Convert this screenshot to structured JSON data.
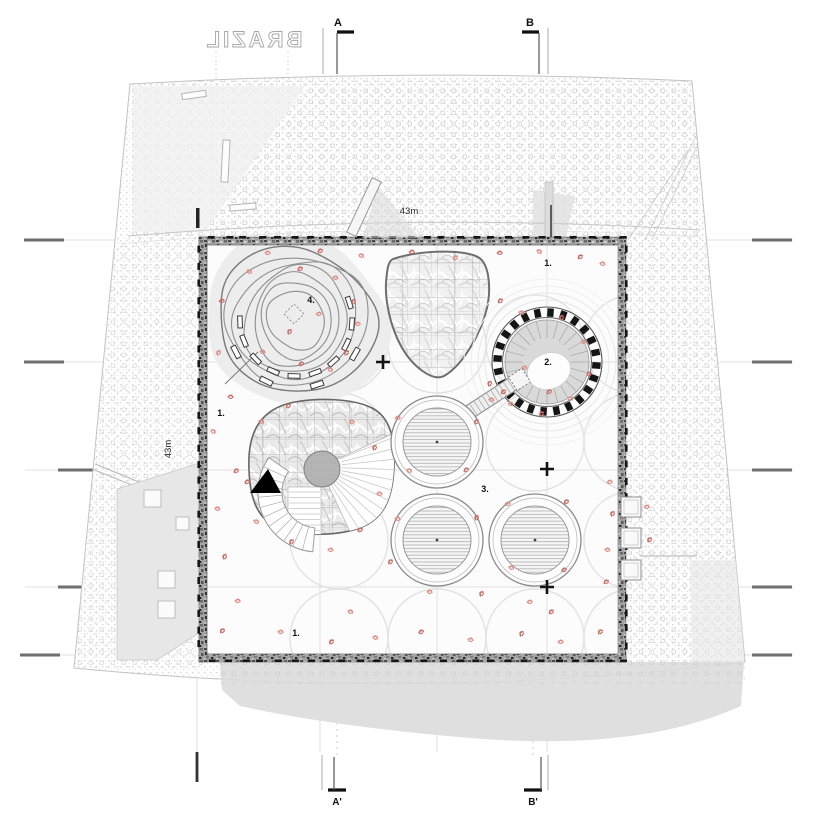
{
  "drawing": {
    "project_name_mirrored": "BRAZIL",
    "dim_top": "43m",
    "dim_left": "43m",
    "section_top_a": "A",
    "section_top_b": "B",
    "section_bottom_a": "A'",
    "section_bottom_b": "B'"
  },
  "area_labels": [
    {
      "text": "1.",
      "x": 548,
      "y": 266
    },
    {
      "text": "1.",
      "x": 221,
      "y": 416
    },
    {
      "text": "1.",
      "x": 296,
      "y": 636
    },
    {
      "text": "2.",
      "x": 548,
      "y": 365
    },
    {
      "text": "3.",
      "x": 485,
      "y": 492
    },
    {
      "text": "4.",
      "x": 311,
      "y": 303
    }
  ],
  "crosses": [
    [
      383,
      362
    ],
    [
      547,
      469
    ],
    [
      547,
      587
    ]
  ],
  "colors": {
    "figure_a": "#dd8e86",
    "figure_b": "#c96e66",
    "wall_base": "#a3a3a3",
    "shadow": "#dcdcdc",
    "faint_line": "#e2e2e2",
    "ink": "#141414"
  },
  "figures": [
    [
      268,
      252,
      20
    ],
    [
      320,
      250,
      -15
    ],
    [
      362,
      255,
      40
    ],
    [
      412,
      251,
      10
    ],
    [
      455,
      257,
      -30
    ],
    [
      500,
      252,
      15
    ],
    [
      540,
      251,
      50
    ],
    [
      580,
      256,
      -20
    ],
    [
      603,
      263,
      30
    ],
    [
      222,
      300,
      10
    ],
    [
      218,
      352,
      -40
    ],
    [
      231,
      396,
      25
    ],
    [
      214,
      431,
      60
    ],
    [
      236,
      470,
      -15
    ],
    [
      218,
      508,
      35
    ],
    [
      224,
      556,
      -50
    ],
    [
      238,
      600,
      15
    ],
    [
      222,
      630,
      -25
    ],
    [
      250,
      271,
      45
    ],
    [
      300,
      268,
      -10
    ],
    [
      336,
      277,
      30
    ],
    [
      353,
      301,
      -45
    ],
    [
      358,
      323,
      15
    ],
    [
      346,
      352,
      -30
    ],
    [
      331,
      369,
      50
    ],
    [
      301,
      363,
      -15
    ],
    [
      263,
      351,
      25
    ],
    [
      289,
      331,
      -40
    ],
    [
      319,
      313,
      10
    ],
    [
      500,
      300,
      -20
    ],
    [
      522,
      312,
      35
    ],
    [
      561,
      317,
      -45
    ],
    [
      584,
      341,
      20
    ],
    [
      589,
      373,
      -10
    ],
    [
      571,
      398,
      40
    ],
    [
      541,
      413,
      -30
    ],
    [
      511,
      403,
      15
    ],
    [
      489,
      383,
      -50
    ],
    [
      525,
      367,
      25
    ],
    [
      549,
      391,
      -15
    ],
    [
      492,
      399,
      30
    ],
    [
      503,
      391,
      -25
    ],
    [
      398,
      417,
      10
    ],
    [
      476,
      421,
      -35
    ],
    [
      410,
      470,
      45
    ],
    [
      466,
      469,
      -15
    ],
    [
      398,
      518,
      25
    ],
    [
      476,
      517,
      -45
    ],
    [
      508,
      503,
      15
    ],
    [
      566,
      501,
      -25
    ],
    [
      512,
      567,
      35
    ],
    [
      564,
      569,
      -10
    ],
    [
      430,
      591,
      20
    ],
    [
      481,
      593,
      -40
    ],
    [
      530,
      601,
      10
    ],
    [
      390,
      561,
      -30
    ],
    [
      262,
      421,
      40
    ],
    [
      288,
      405,
      -20
    ],
    [
      352,
      421,
      15
    ],
    [
      374,
      447,
      -45
    ],
    [
      380,
      493,
      30
    ],
    [
      360,
      529,
      -10
    ],
    [
      331,
      549,
      25
    ],
    [
      291,
      541,
      -35
    ],
    [
      257,
      521,
      45
    ],
    [
      247,
      481,
      -15
    ],
    [
      281,
      631,
      20
    ],
    [
      331,
      641,
      -30
    ],
    [
      376,
      637,
      40
    ],
    [
      421,
      631,
      -10
    ],
    [
      471,
      639,
      25
    ],
    [
      521,
      633,
      -45
    ],
    [
      561,
      641,
      15
    ],
    [
      600,
      631,
      -25
    ],
    [
      351,
      611,
      35
    ],
    [
      551,
      611,
      -20
    ],
    [
      610,
      481,
      10
    ],
    [
      612,
      513,
      -40
    ],
    [
      608,
      549,
      30
    ],
    [
      606,
      581,
      -15
    ],
    [
      647,
      506,
      20
    ],
    [
      649,
      539,
      -35
    ]
  ]
}
